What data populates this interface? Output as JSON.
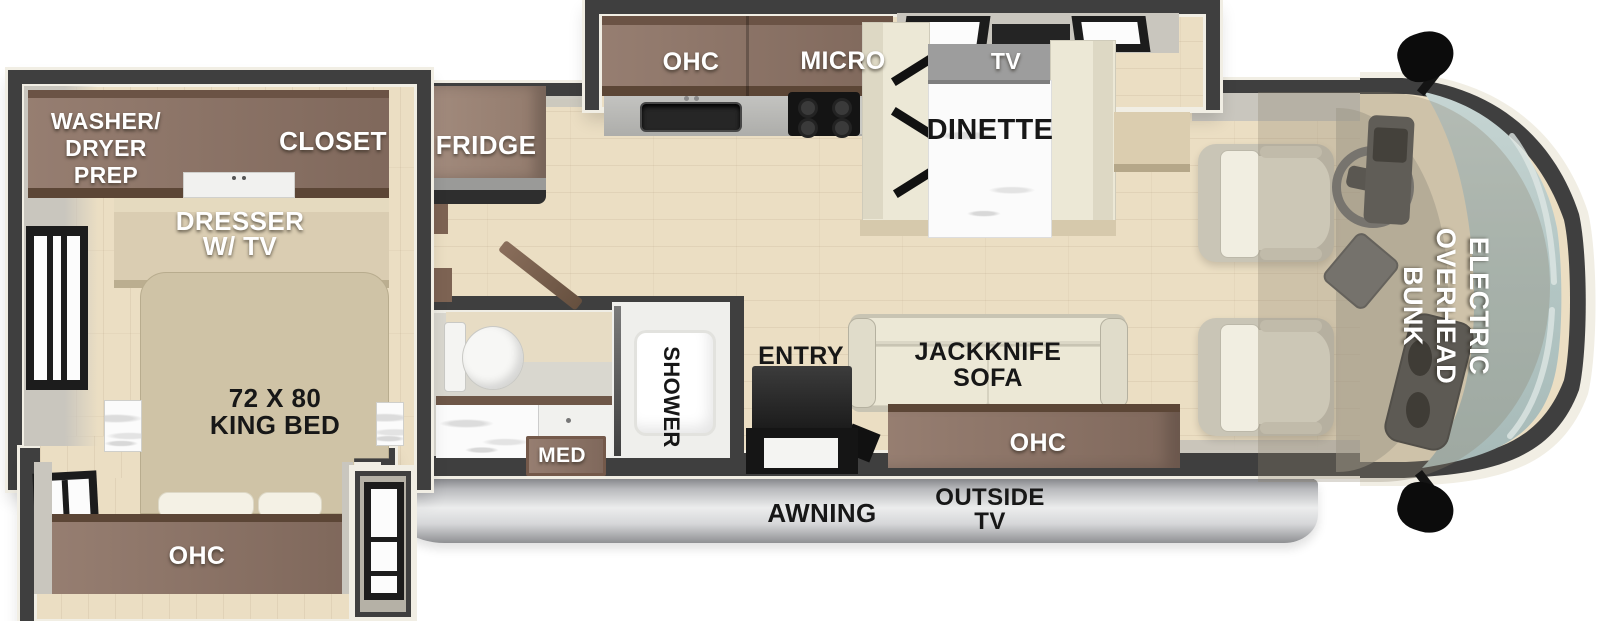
{
  "title": "RV floor plan",
  "palette": {
    "wall": "#3f3f3f",
    "trim": "#f1eee4",
    "floor": "#ebdec3",
    "cabinet": "#8e7466",
    "cabinetTop": "#6b5345",
    "cabinetEdge": "#5c4636",
    "cabinetLight": "#9b8273",
    "dresser": "#dacdb2",
    "bed": "#cfc3a6",
    "pillow": "#f4f1e5",
    "cream": "#ece8d6",
    "creamDark": "#ddd8c4",
    "marble": "#fbfbfb",
    "grayWall": "#c9c6be",
    "counter": "#b7b7b4",
    "sink": "#262626",
    "stove": "#141414",
    "tvGray": "#9d9d9d",
    "awningDark": "#87888c",
    "awningLight": "#eceded",
    "glassTop": "#c6d5d3",
    "glassBottom": "#a7bab8",
    "bunkOverlay": "rgba(140,130,108,0.30)",
    "seat": "#e9e5d6",
    "seatBack": "#f1eee1",
    "dash": "#4e4e4e",
    "black": "#0c0c0c"
  },
  "labels": {
    "washer_dryer_prep": "WASHER/\nDRYER\nPREP",
    "closet": "CLOSET",
    "dresser_tv": "DRESSER\nW/ TV",
    "king_bed": "72 X 80\nKING BED",
    "bedroom_ohc": "OHC",
    "fridge": "FRIDGE",
    "kitchen_ohc": "OHC",
    "micro": "MICRO",
    "tv": "TV",
    "dinette": "DINETTE",
    "med": "MED",
    "shower": "SHOWER",
    "entry": "ENTRY",
    "jackknife_sofa": "JACKKNIFE\nSOFA",
    "sofa_ohc": "OHC",
    "electric_overhead_bunk": "ELECTRIC\nOVERHEAD\nBUNK",
    "awning": "AWNING",
    "outside_tv": "OUTSIDE\nTV"
  }
}
